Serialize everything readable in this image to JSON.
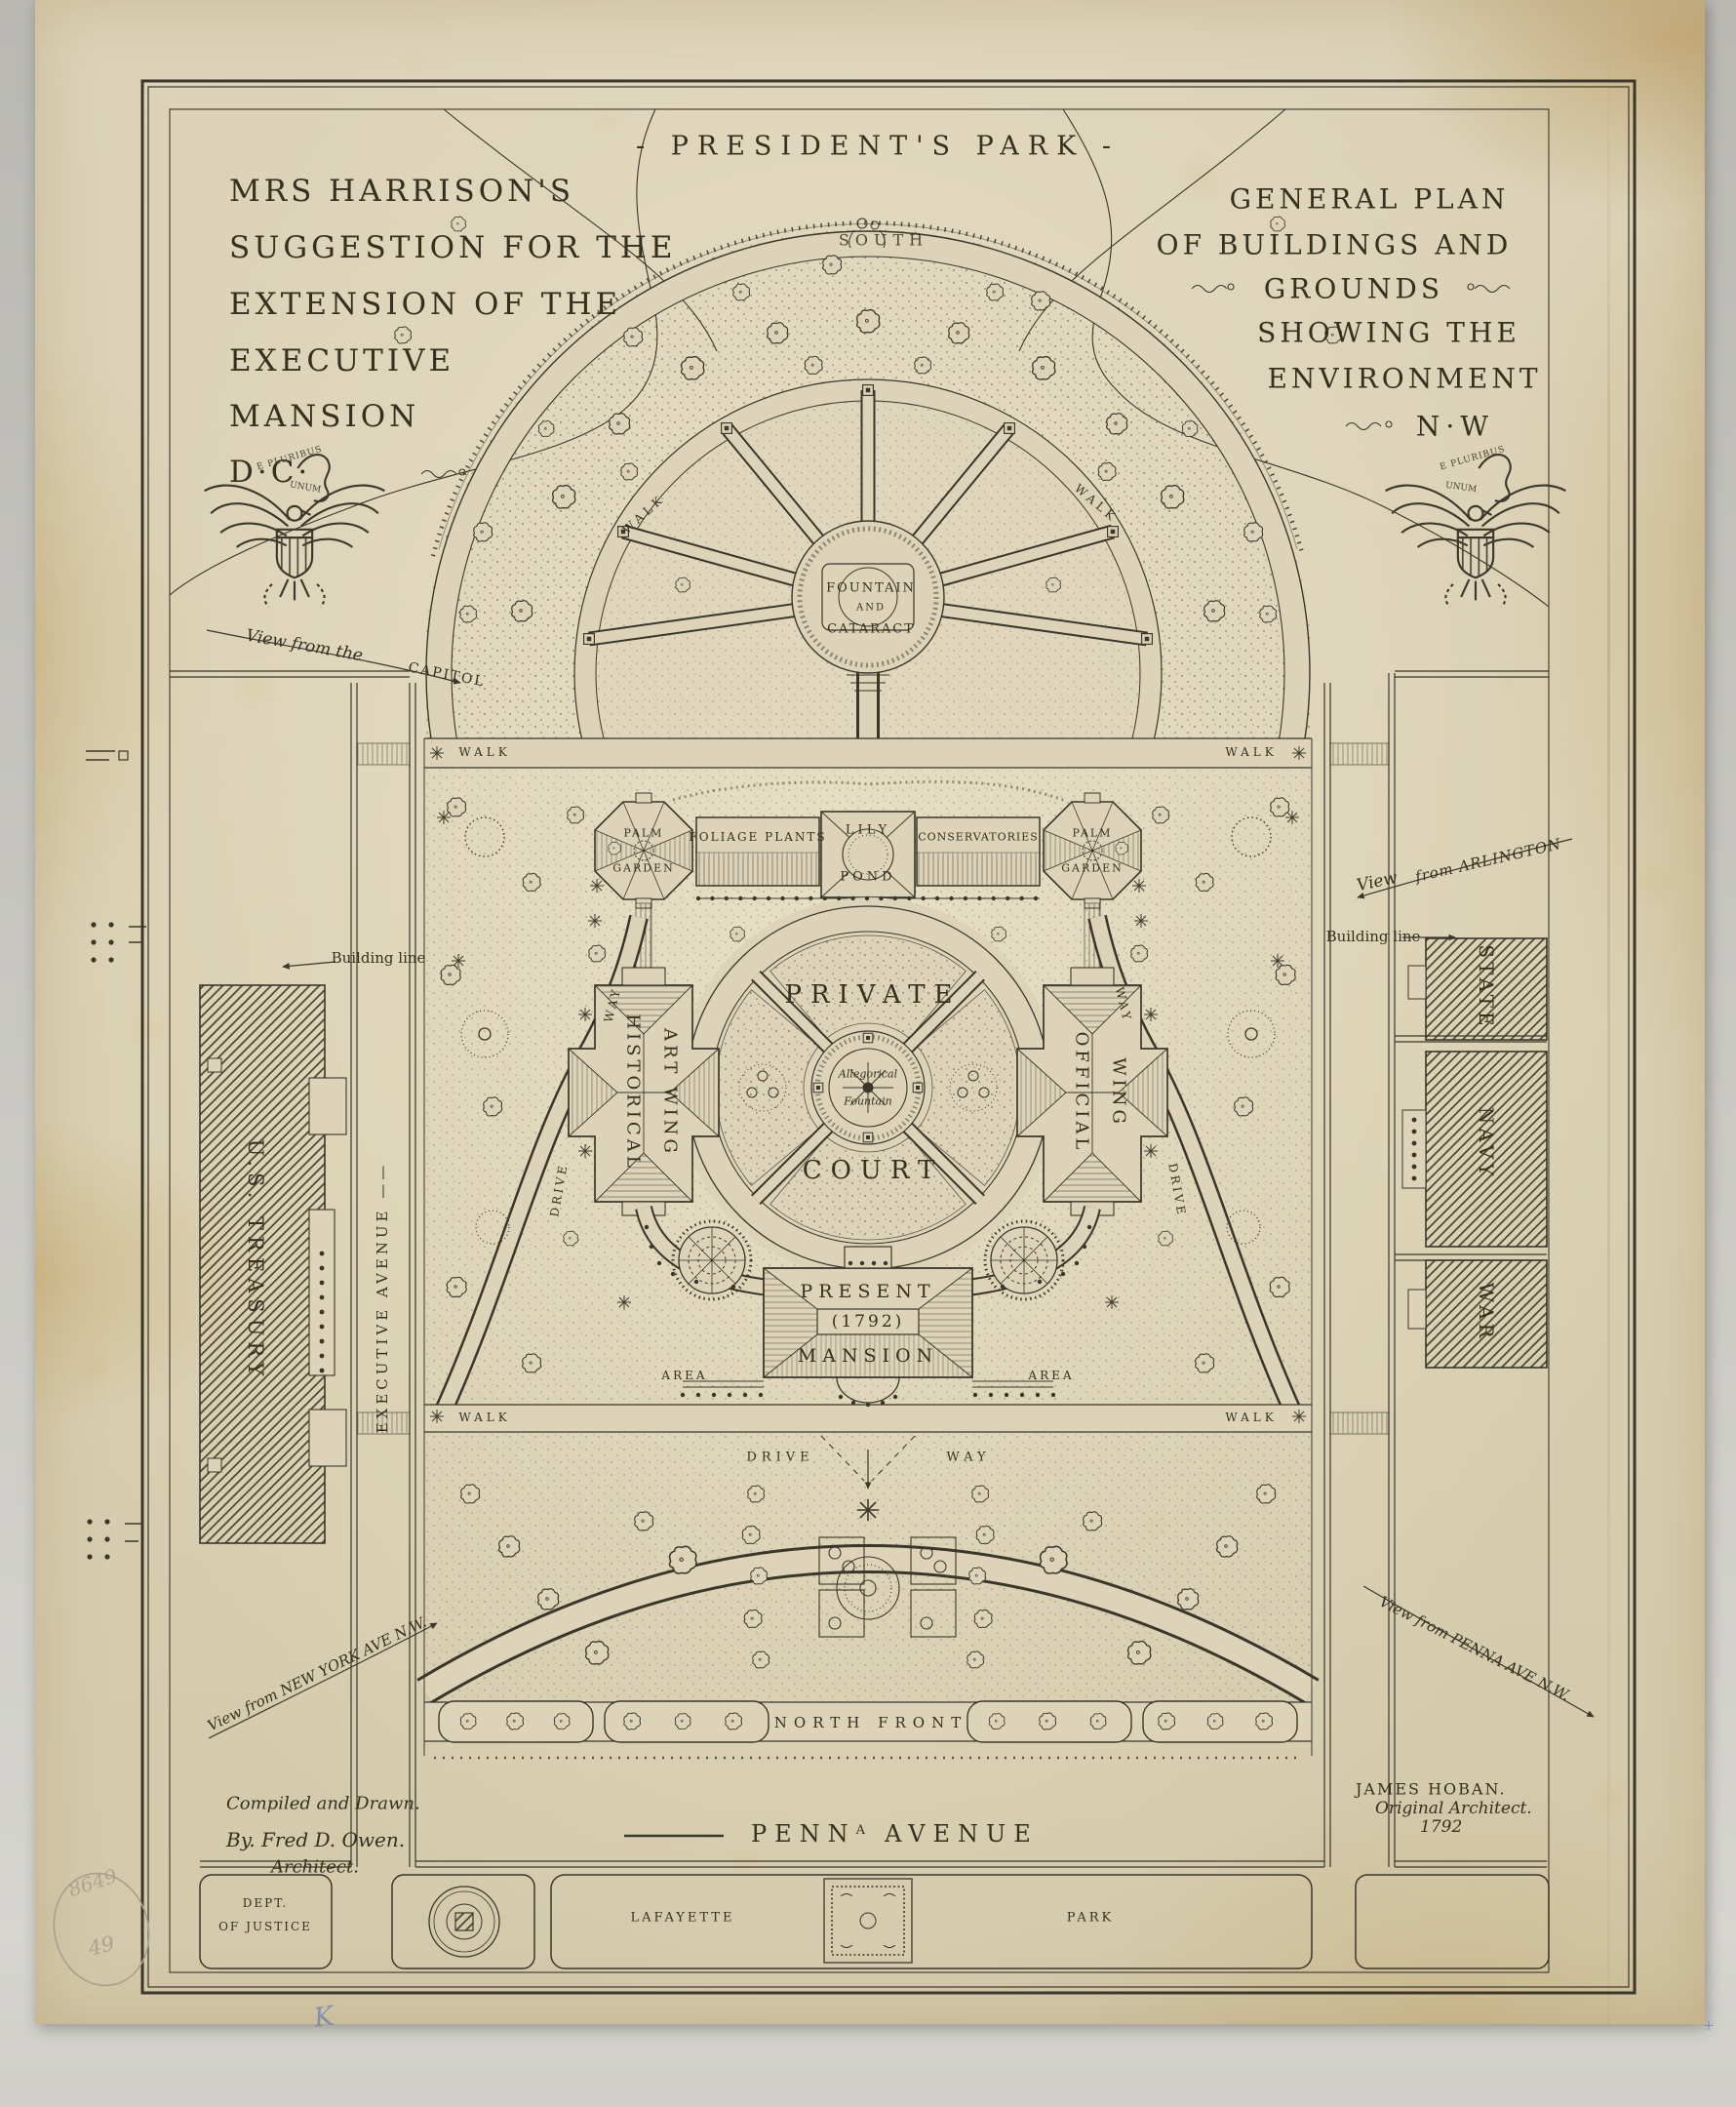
{
  "header": {
    "park_title": "- PRESIDENT'S PARK -",
    "south": "SOUTH"
  },
  "title_left": {
    "lines": [
      "MRS HARRISON'S",
      "SUGGESTION FOR THE",
      "EXTENSION OF THE",
      "EXECUTIVE",
      "MANSION",
      "D·C·"
    ]
  },
  "title_right": {
    "lines": [
      "GENERAL PLAN",
      "OF BUILDINGS AND",
      "GROUNDS",
      "SHOWING THE",
      "ENVIRONMENT",
      "N·W"
    ]
  },
  "emblem": {
    "motto_line1": "E PLURIBUS",
    "motto_line2": "UNUM"
  },
  "park": {
    "walk": "WALK",
    "fountain_line1": "FOUNTAIN",
    "fountain_line2": "AND",
    "fountain_line3": "CATARACT",
    "palm": "PALM",
    "garden": "GARDEN",
    "foliage_plants": "FOLIAGE PLANTS",
    "lily": "LILY",
    "pond": "POND",
    "conservatories": "CONSERVATORIES",
    "private": "PRIVATE",
    "court": "COURT",
    "allegorical_line1": "Allegorical",
    "allegorical_line2": "Fountain",
    "historical": "HISTORICAL",
    "art_wing": "ART WING",
    "official": "OFFICIAL",
    "wing": "WING",
    "present": "PRESENT",
    "year": "(1792)",
    "mansion": "MANSION",
    "area": "AREA",
    "drive": "DRIVE",
    "way": "WAY",
    "north_front": "NORTH FRONT"
  },
  "streets": {
    "executive_avenue": "EXECUTIVE AVENUE ——",
    "penna_prefix": "PENN",
    "penna_sup": "A",
    "penna_suffix": "AVENUE",
    "building_line": "Building line"
  },
  "views": {
    "capitol_pre": "View from the",
    "capitol": "CAPITOL",
    "arlington_pre": "View",
    "arlington": "from ARLINGTON",
    "new_york": "View from NEW YORK AVE N.W.",
    "penna": "View from PENNA AVE N.W."
  },
  "buildings": {
    "treasury": "U.S. TREASURY",
    "state": "STATE",
    "navy": "NAVY",
    "war": "WAR",
    "justice_line1": "DEPT.",
    "justice_line2": "OF JUSTICE",
    "lafayette": "LAFAYETTE",
    "lafayette_park": "PARK"
  },
  "credits": {
    "compiled_line1": "Compiled and Drawn.",
    "compiled_line2": "By. Fred D. Owen.",
    "compiled_line3": "Architect.",
    "hoban_line1": "JAMES HOBAN.",
    "hoban_line2": "Original Architect.",
    "hoban_line3": "1792"
  },
  "annotations": {
    "pencil_number": "8649",
    "circled_number": "49",
    "blue_mark": "K",
    "corner_mark": "+"
  }
}
